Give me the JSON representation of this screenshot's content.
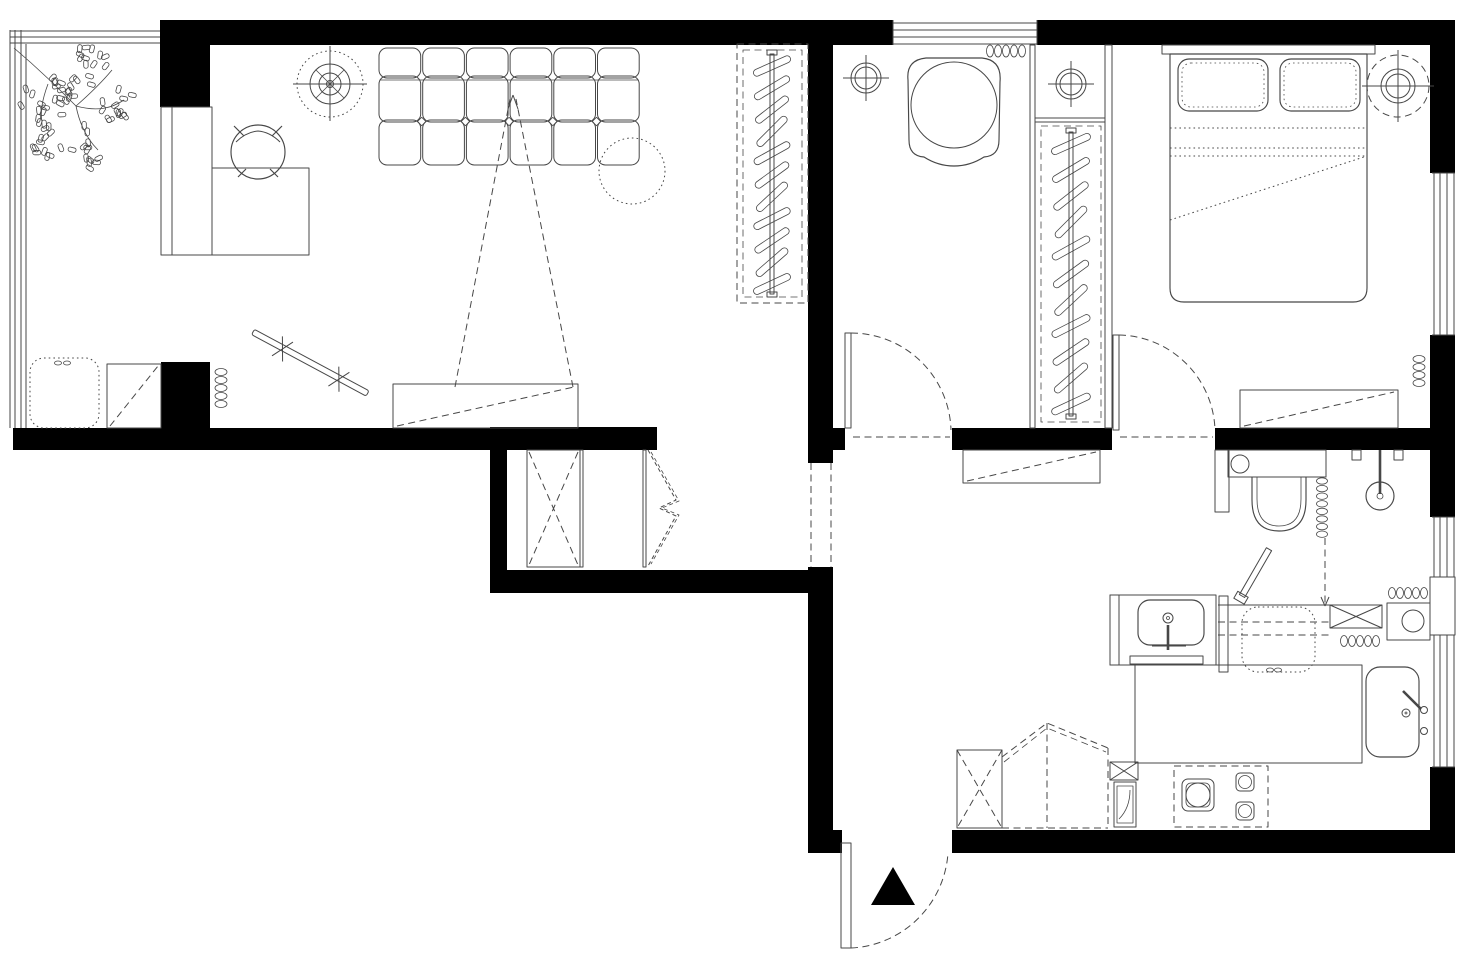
{
  "meta": {
    "title": "Apartment floor plan",
    "drawing_type": "architectural floor plan, top view, black and white line drawing"
  },
  "palette": {
    "background": "#ffffff",
    "wall": "#000000",
    "line": "#474747"
  },
  "rooms": {
    "living_room": {
      "name": "Living room",
      "items": [
        "potted-plant",
        "balcony-window",
        "corner-desk",
        "desk-chair",
        "ceiling-fan-light",
        "modular-sofa",
        "round-side-table-dotted",
        "wardrobe-hanging-rail",
        "tv-viewing-cone",
        "tv-stand",
        "storage-cabinet",
        "pouf-dotted",
        "radiator",
        "wall-mounted-rack"
      ]
    },
    "small_bedroom": {
      "name": "Small bedroom",
      "items": [
        "top-window",
        "armchair",
        "ceiling-light",
        "radiator",
        "swing-door"
      ]
    },
    "walk_in_closet": {
      "name": "Walk-in closet column",
      "items": [
        "ceiling-light",
        "hanging-rail-closet"
      ]
    },
    "main_bedroom": {
      "name": "Main bedroom",
      "items": [
        "double-bed",
        "pillow-left",
        "pillow-right",
        "ceiling-light-dashed",
        "radiator",
        "dresser",
        "swing-door",
        "side-window"
      ]
    },
    "hallway": {
      "name": "Hallway",
      "items": [
        "built-in-closet",
        "bifold-door",
        "console-table",
        "passage-opening",
        "lintel-dashes"
      ]
    },
    "bathroom": {
      "name": "Bathroom",
      "items": [
        "cistern-shelf",
        "toilet",
        "towel-radiator",
        "shower-head",
        "shower-valves",
        "glass-screen-dashed",
        "swing-door-leaf",
        "vanity-basin",
        "faucet",
        "bath-mat",
        "washing-machine-dotted"
      ]
    },
    "kitchen_entry": {
      "name": "Kitchen / entry",
      "items": [
        "counter-table",
        "kitchen-sink",
        "gas-hob-dashed",
        "crossed-cabinet",
        "fold-down-table-dashed",
        "tall-appliance",
        "water-heater",
        "wall-niche",
        "radiator-upper",
        "radiator-lower",
        "entry-door",
        "entrance-arrow",
        "side-windows"
      ]
    }
  }
}
